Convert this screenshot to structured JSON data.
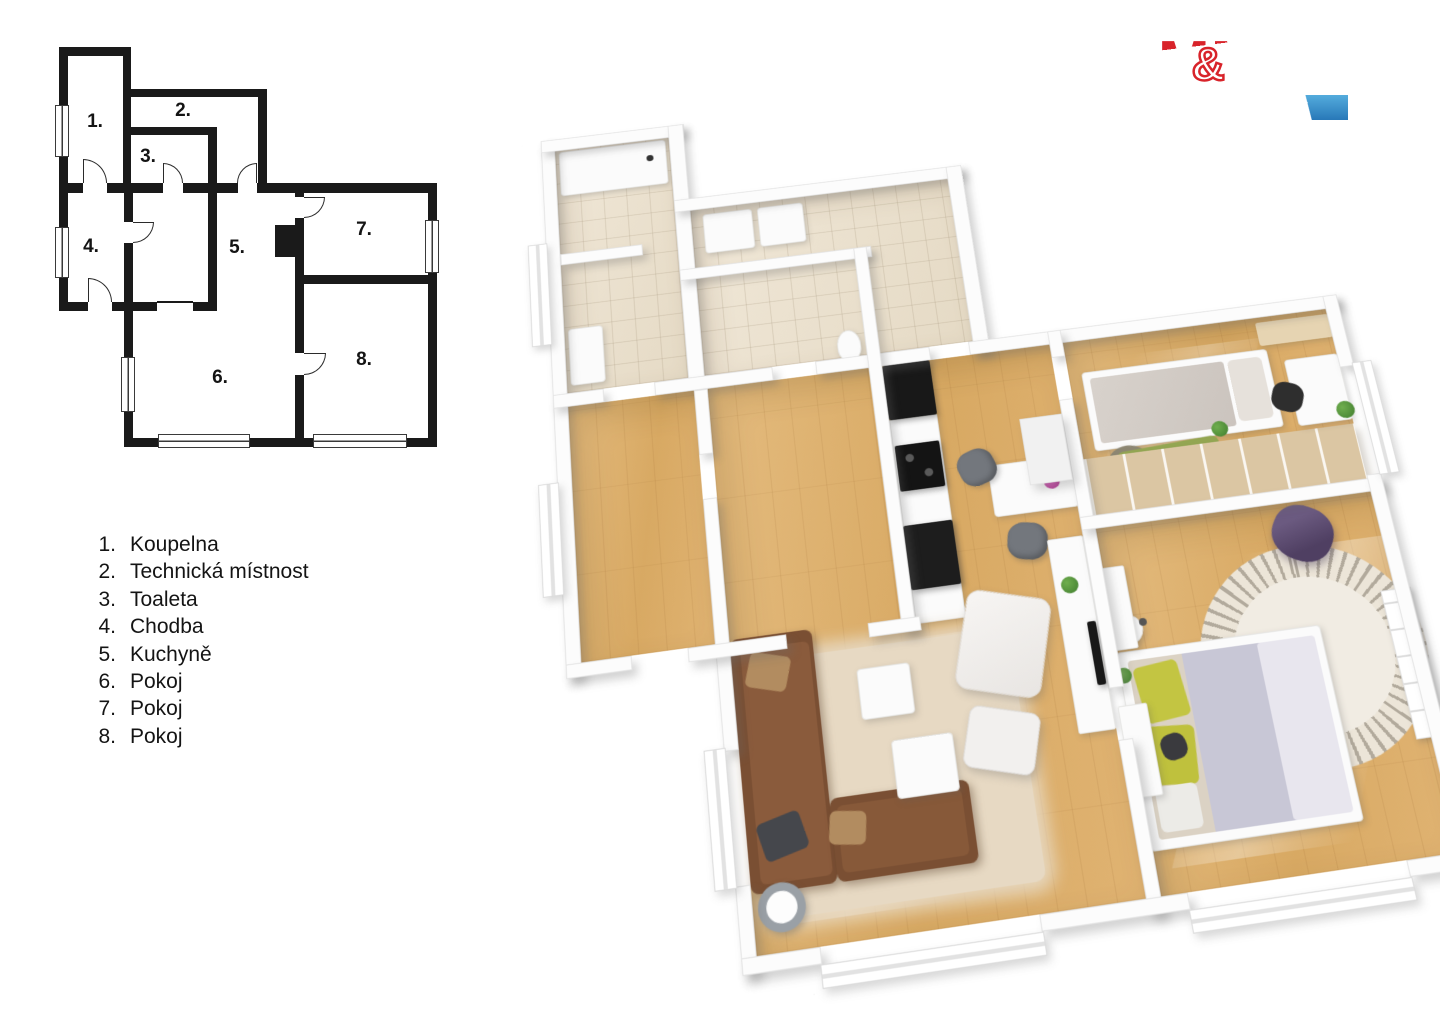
{
  "logo": {
    "m_left": "M",
    "amp": "&",
    "m_right": "M",
    "reality": "REALITY",
    "brand_red": "#d8232a",
    "brand_blue": "#2f86c5"
  },
  "legend": {
    "items": [
      {
        "num": "1.",
        "label": "Koupelna"
      },
      {
        "num": "2.",
        "label": "Technická místnost"
      },
      {
        "num": "3.",
        "label": "Toaleta"
      },
      {
        "num": "4.",
        "label": "Chodba"
      },
      {
        "num": "5.",
        "label": "Kuchyně"
      },
      {
        "num": "6.",
        "label": "Pokoj"
      },
      {
        "num": "7.",
        "label": "Pokoj"
      },
      {
        "num": "8.",
        "label": "Pokoj"
      }
    ]
  },
  "plan2d": {
    "wall_color": "#1a1a1a"
  },
  "plan3d": {
    "colors": {
      "wood_floor": "#ddb072",
      "tile_floor": "#eae1d0",
      "wall_white": "#fbfbfb",
      "sofa_brown": "#7a4f33",
      "rug_beige": "#e7d9c3",
      "bed_blanket_lavender": "#c8c7d6",
      "pillow_yellow": "#c3c542",
      "armchair_purple": "#5a4a6d",
      "kids_rug_green": "#94a752",
      "wardrobe_wood": "#dbc6a3",
      "flower_pink": "#c93fa6",
      "plant_green": "#4e8f3a",
      "appliance_black": "#181818"
    }
  }
}
